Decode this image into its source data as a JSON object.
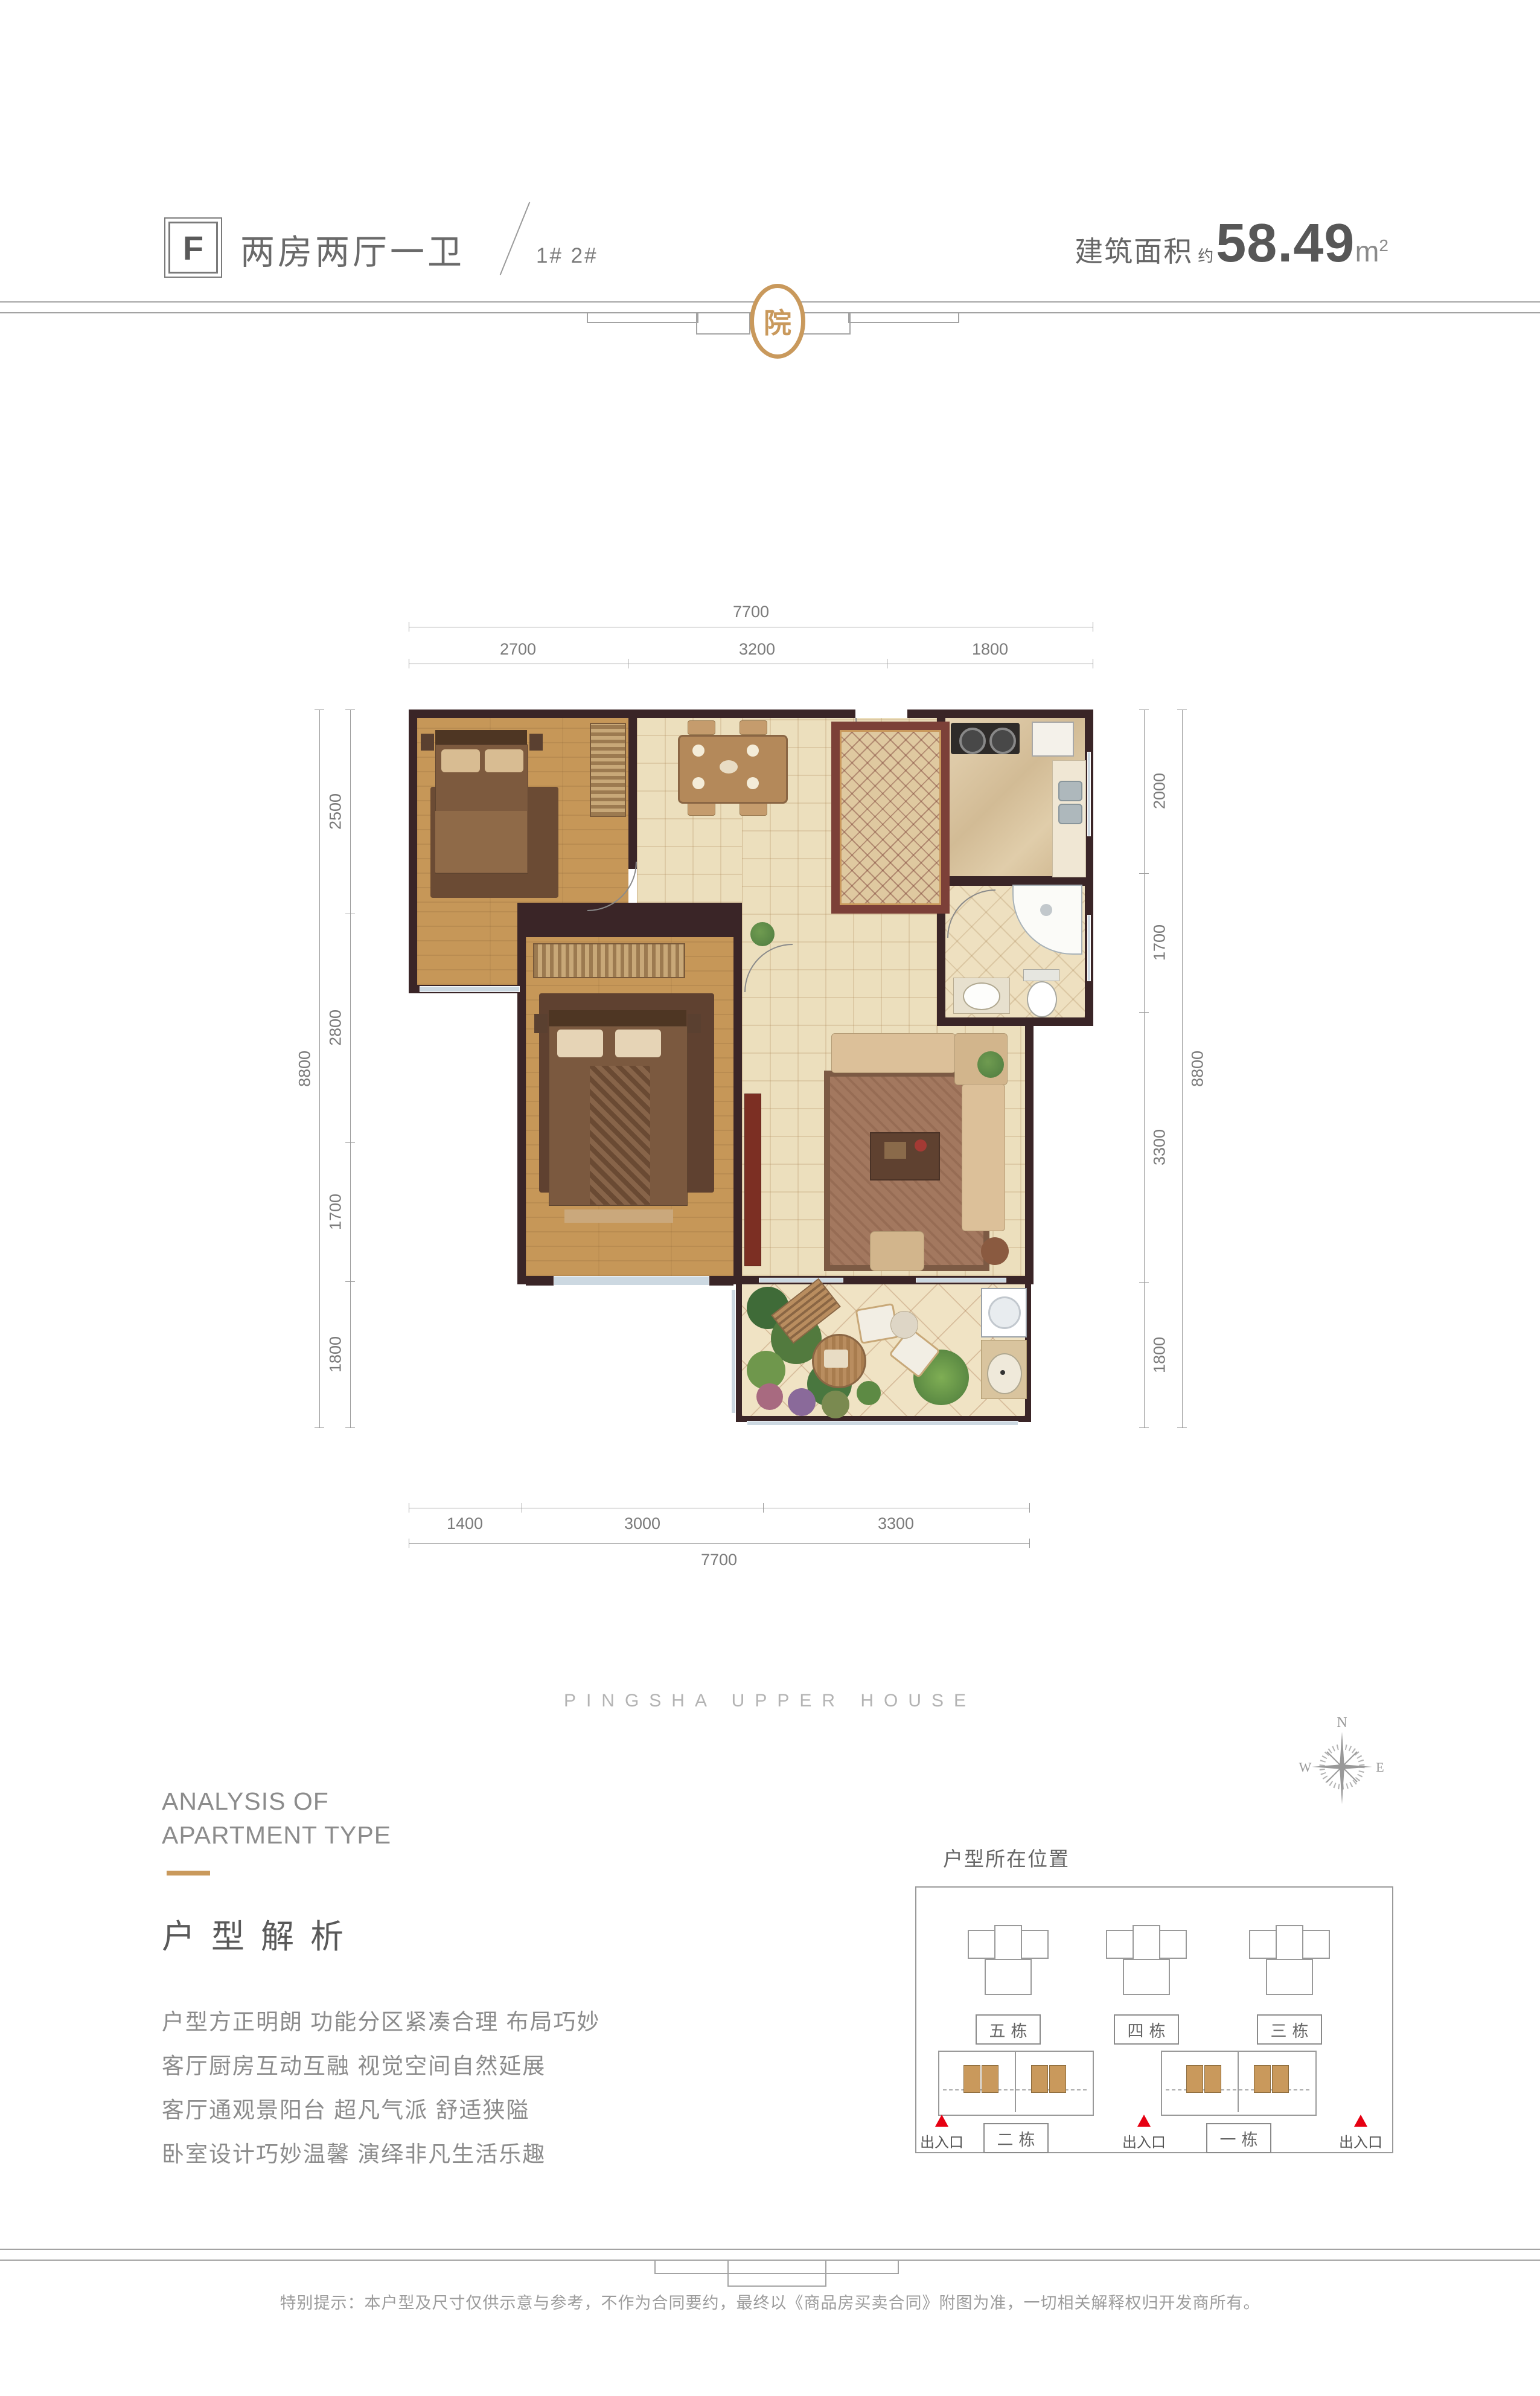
{
  "header": {
    "type_letter": "F",
    "type_name": "两房两厅一卫",
    "buildings": "1# 2#",
    "area_label": "建筑面积",
    "area_approx": "约",
    "area_value": "58.49",
    "area_unit": "m",
    "area_sup": "2"
  },
  "brand": {
    "logo_char": "院",
    "wordmark": "PINGSHA UPPER HOUSE"
  },
  "floorplan": {
    "dims_top": {
      "overall": "7700",
      "segments": [
        "2700",
        "3200",
        "1800"
      ]
    },
    "dims_bottom": {
      "overall": "7700",
      "segments": [
        "1400",
        "3000",
        "3300"
      ]
    },
    "dims_left": {
      "overall": "8800",
      "segments": [
        "2500",
        "2800",
        "1700",
        "1800"
      ]
    },
    "dims_right": {
      "overall": "8800",
      "segments": [
        "2000",
        "1700",
        "3300",
        "1800"
      ]
    }
  },
  "analysis": {
    "en_line1": "ANALYSIS OF",
    "en_line2": "APARTMENT TYPE",
    "zh_title": "户型解析",
    "points": [
      "户型方正明朗 功能分区紧凑合理 布局巧妙",
      "客厅厨房互动互融 视觉空间自然延展",
      "客厅通观景阳台 超凡气派 舒适狭隘",
      "卧室设计巧妙温馨 演绎非凡生活乐趣"
    ]
  },
  "location": {
    "title": "户型所在位置",
    "top_buildings": [
      "五栋",
      "四栋",
      "三栋"
    ],
    "bottom_buildings": [
      "二栋",
      "一栋"
    ],
    "entrance_label": "出入口",
    "compass": {
      "n": "N",
      "w": "W",
      "e": "E"
    }
  },
  "footer": {
    "disclaimer": "特别提示：本户型及尺寸仅供示意与参考，不作为合同要约，最终以《商品房买卖合同》附图为准，一切相关解释权归开发商所有。"
  },
  "colors": {
    "accent_gold": "#c9995c",
    "wall_dark": "#3a2527",
    "entrance_red": "#e60012"
  }
}
